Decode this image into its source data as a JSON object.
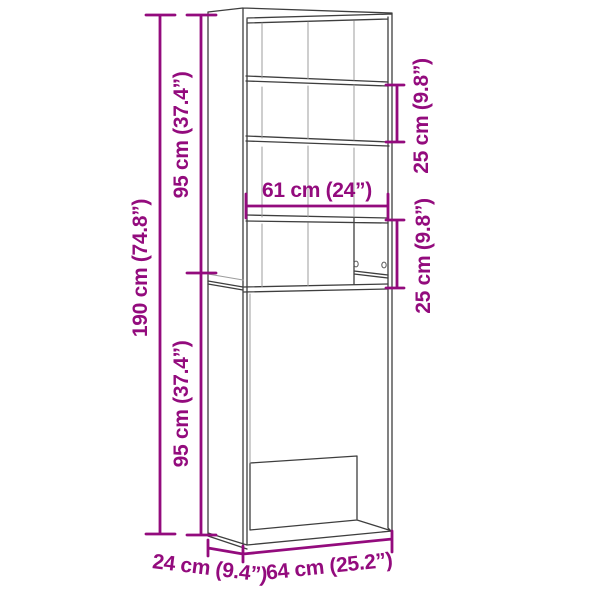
{
  "diagram": {
    "type": "furniture-dimension-diagram",
    "subject": "tall washing machine storage cabinet with shelves",
    "colors": {
      "dimension_accent": "#930B7D",
      "outline": "#3E3E3E",
      "interior_line": "#9C9C9C",
      "background": "#FFFFFF"
    },
    "labels": {
      "total_height": "190 cm (74.8”)",
      "upper_height": "95 cm (37.4”)",
      "lower_height": "95 cm (37.4”)",
      "top_shelf_spacing": "25 cm (9.8”)",
      "middle_shelf_spacing": "25 cm (9.8”)",
      "inner_width": "61 cm (24”)",
      "depth": "24 cm (9.4”)",
      "outer_width": "64 cm (25.2”)"
    }
  }
}
